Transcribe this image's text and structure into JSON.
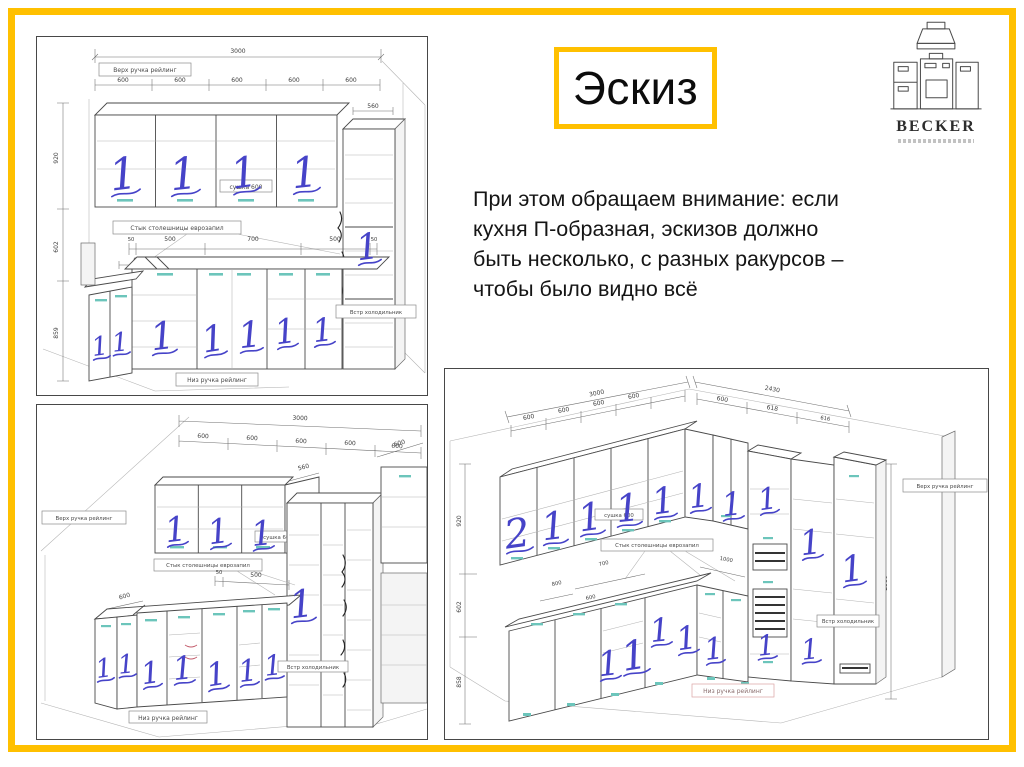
{
  "slide": {
    "title": "Эскиз",
    "body_lines": [
      "При этом обращаем внимание: если",
      "кухня П-образная, эскизов должно",
      "быть несколько, с разных ракурсов –",
      "чтобы было видно всё"
    ],
    "accent_color": "#FFC000"
  },
  "logo": {
    "brand": "BECKER"
  },
  "marks": {
    "one": "1",
    "two": "2"
  },
  "sk1": {
    "dim_total": "3000",
    "dim_unit": "600",
    "dim_depth": "560",
    "dim_h_upper": "920",
    "dim_h_mid": "602",
    "dim_h_base": "859",
    "dim_c50": "50",
    "dim_c500": "500",
    "dim_c700": "700",
    "dim_corner": "600",
    "label_top_rail": "Верх ручка рейлинг",
    "label_dryer": "сушка 600",
    "label_joint": "Стык столешницы еврозапил",
    "label_fridge": "Встр холодильник",
    "label_bottom_rail": "Низ ручка рейлинг"
  },
  "sk2": {
    "dim_total": "3000",
    "dim_unit": "600",
    "dim_depth": "560",
    "dim_c50": "50",
    "dim_c500": "500",
    "dim_corner": "600",
    "label_top_rail": "Верх ручка рейлинг",
    "label_dryer": "сушка 600",
    "label_joint": "Стык столешницы еврозапил",
    "label_fridge": "Встр холодильник",
    "label_bottom_rail": "Низ ручка рейлинг"
  },
  "sk3": {
    "dim_total_left": "3000",
    "dim_total_right": "2430",
    "dim_unit": "600",
    "dim_unit_b": "618",
    "dim_unit_c": "616",
    "dim_h_upper": "920",
    "dim_h_mid": "602",
    "dim_h_base": "858",
    "dim_height_right": "2580",
    "dim_c700": "700",
    "dim_c800": "800",
    "dim_c1000": "1000",
    "dim_c600": "600",
    "label_top_rail": "Верх ручка рейлинг",
    "label_dryer": "сушка 600",
    "label_joint": "Стык столешницы еврозапил",
    "label_fridge": "Встр холодильник",
    "label_bottom_rail": "Низ ручка рейлинг"
  }
}
